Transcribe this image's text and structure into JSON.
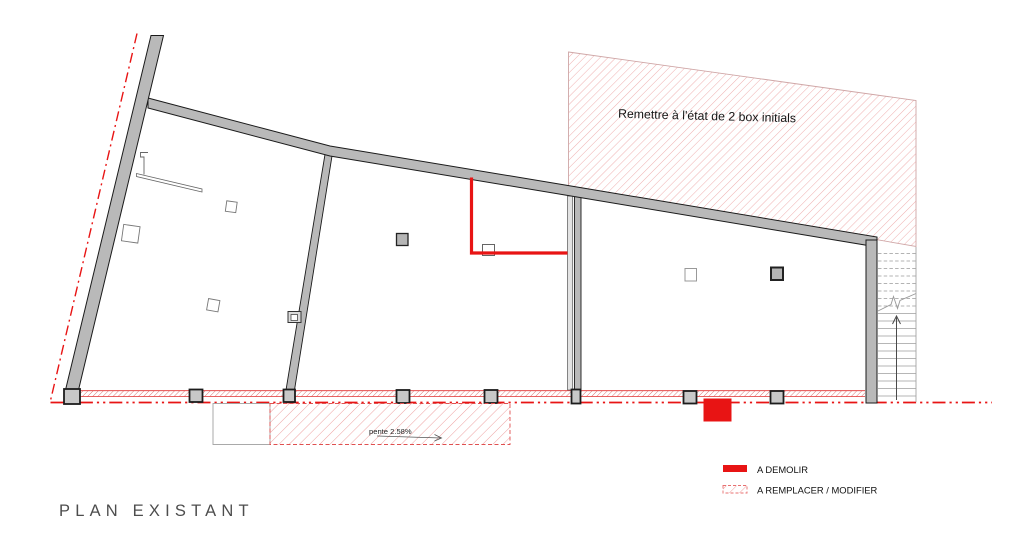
{
  "title": "PLAN EXISTANT",
  "plan": {
    "zone_annotation": "Remettre à l'état de 2 box initials",
    "ramp_label": "pente 2.58%"
  },
  "legend": {
    "items": [
      {
        "label": "A DEMOLIR",
        "swatch": "solid-red"
      },
      {
        "label": "A REMPLACER / MODIFIER",
        "swatch": "red-hatched"
      }
    ]
  },
  "colors": {
    "demolition_red": "#e81414",
    "hatch_pink": "#efaeae",
    "band_hatch_red": "#dd6666",
    "wall_gray": "#b9b9b9",
    "column_gray": "#c8c8c8",
    "title_gray": "#4d4d4d"
  }
}
